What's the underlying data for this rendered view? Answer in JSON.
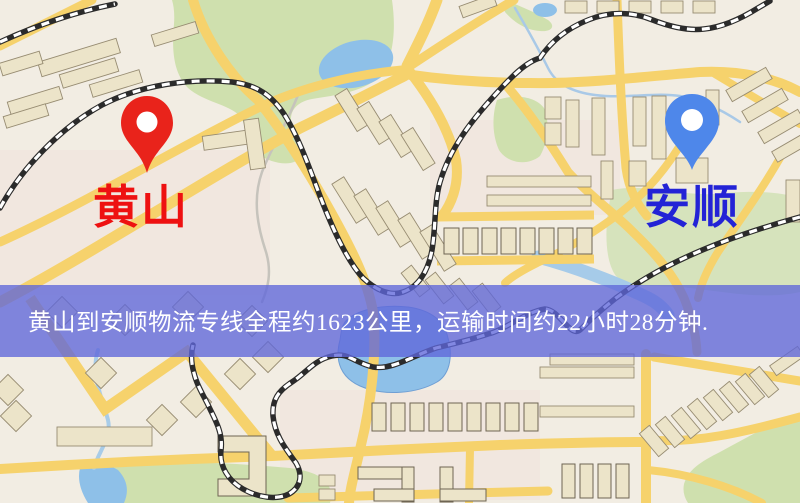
{
  "map": {
    "origin": {
      "name": "黄山"
    },
    "destination": {
      "name": "安顺"
    },
    "banner": {
      "text": "黄山到安顺物流专线全程约1623公里，运输时间约22小时28分钟."
    },
    "colors": {
      "origin_pin": "#e9231b",
      "origin_label": "#ee1111",
      "destination_pin": "#4e87ea",
      "destination_label": "#2323d6",
      "banner_bg": "rgba(95,102,218,0.78)",
      "banner_text": "#ffffff",
      "road": "#f6d26c",
      "park": "#cfe0ae",
      "park_light": "#d6e3bc",
      "water": "#8ec0e8",
      "building": "#ece4c9",
      "railway": "#2b2b2b",
      "background": "#f2ede3"
    }
  }
}
